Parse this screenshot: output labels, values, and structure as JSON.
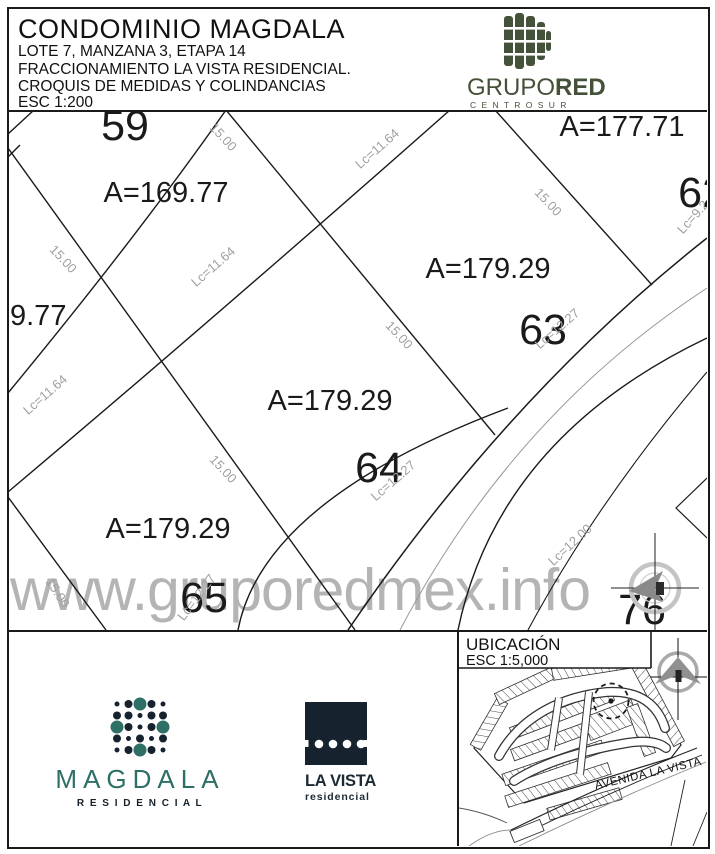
{
  "header": {
    "title": "CONDOMINIO MAGDALA",
    "lines": [
      "LOTE 7, MANZANA 3, ETAPA 14",
      "FRACCIONAMIENTO LA VISTA RESIDENCIAL.",
      "CROQUIS DE MEDIDAS Y COLINDANCIAS",
      "ESC 1:200"
    ],
    "logo": {
      "brand_regular": "GRUPO",
      "brand_bold": "RED",
      "tagline": "C E N T R O   S U R",
      "color": "#44523a"
    }
  },
  "plan": {
    "watermark": "www.gruporedmex.info",
    "lot_numbers": [
      {
        "text": "59",
        "x": 117,
        "y": 30
      },
      {
        "text": "62",
        "x": 694,
        "y": 97
      },
      {
        "text": "63",
        "x": 535,
        "y": 234
      },
      {
        "text": "64",
        "x": 371,
        "y": 372
      },
      {
        "text": "65",
        "x": 196,
        "y": 502
      },
      {
        "text": "76",
        "x": 634,
        "y": 514
      }
    ],
    "area_labels": [
      {
        "text": "A=169.77",
        "x": 158,
        "y": 92
      },
      {
        "text": "A=177.71",
        "x": 614,
        "y": 26
      },
      {
        "text": "A=179.29",
        "x": 480,
        "y": 168
      },
      {
        "text": "A=179.29",
        "x": 322,
        "y": 300
      },
      {
        "text": "A=179.29",
        "x": 160,
        "y": 428
      },
      {
        "text": "9.77",
        "x": 2,
        "y": 215,
        "anchor": "start"
      }
    ],
    "dim_labels": [
      {
        "text": "15.00",
        "x": 212,
        "y": 30,
        "r": 47
      },
      {
        "text": "Lc=11.64",
        "x": 372,
        "y": 42,
        "r": -41
      },
      {
        "text": "15.00",
        "x": 52,
        "y": 152,
        "r": 47
      },
      {
        "text": "Lc=11.64",
        "x": 208,
        "y": 160,
        "r": -41
      },
      {
        "text": "Lc=11.64",
        "x": 40,
        "y": 288,
        "r": -41
      },
      {
        "text": "15.00",
        "x": 537,
        "y": 95,
        "r": 47
      },
      {
        "text": "Lc=9.2",
        "x": 688,
        "y": 110,
        "r": -48
      },
      {
        "text": "15.00",
        "x": 388,
        "y": 228,
        "r": 47
      },
      {
        "text": "Lc=12.27",
        "x": 552,
        "y": 222,
        "r": -41
      },
      {
        "text": "15.00",
        "x": 212,
        "y": 362,
        "r": 47
      },
      {
        "text": "Lc=12.27",
        "x": 388,
        "y": 374,
        "r": -41
      },
      {
        "text": "Lc=12.00",
        "x": 565,
        "y": 438,
        "r": -43
      },
      {
        "text": "15.00",
        "x": 46,
        "y": 485,
        "r": 57
      },
      {
        "text": "Lc=12.27",
        "x": 192,
        "y": 490,
        "r": -53
      }
    ]
  },
  "ubicacion": {
    "title": "UBICACIÓN",
    "scale": "ESC 1:5,000",
    "road_label": "AVENIDA LA VISTA"
  },
  "footer": {
    "magdala": {
      "name": "MAGDALA",
      "tagline": "R E S I D E N C I A L"
    },
    "lavista": {
      "name": "LA VISTA",
      "tagline": "residencial"
    }
  },
  "colors": {
    "line": "#1a1a1a",
    "dim_gray": "#a0a0a0",
    "watermark_gray": "#b4b4b4",
    "grupored_green": "#44523a",
    "magdala_teal": "#2e6f66",
    "brand_navy": "#16222e"
  }
}
